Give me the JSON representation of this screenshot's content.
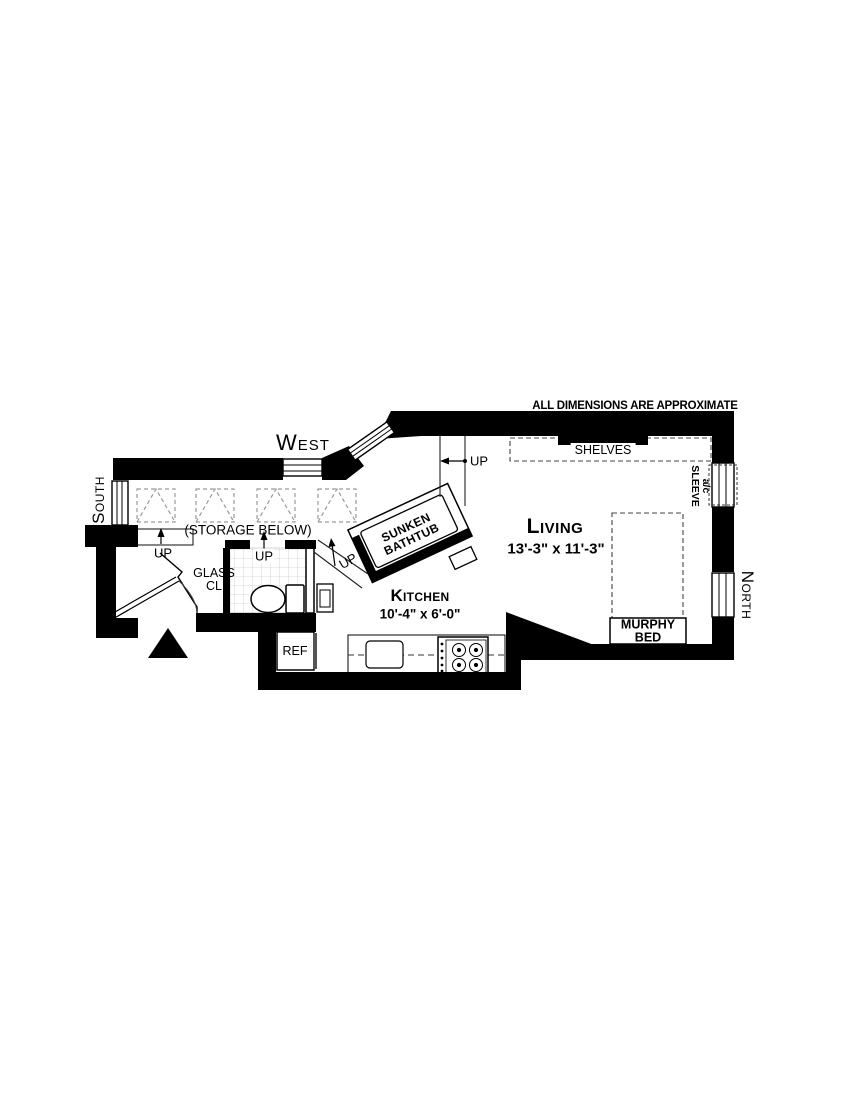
{
  "floorplan": {
    "disclaimer": "ALL DIMENSIONS ARE APPROXIMATE",
    "compass": {
      "west": "West",
      "south": "South",
      "north": "North"
    },
    "rooms": {
      "living": {
        "name": "Living",
        "dims": "13'-3\" x 11'-3\""
      },
      "kitchen": {
        "name": "Kitchen",
        "dims": "10'-4\" x 6'-0\""
      }
    },
    "labels": {
      "shelves": "SHELVES",
      "storage_below": "(STORAGE BELOW)",
      "glass_closet_1": "GLASS",
      "glass_closet_2": "CL",
      "bathtub_1": "SUNKEN",
      "bathtub_2": "BATHTUB",
      "murphy_1": "MURPHY",
      "murphy_2": "BED",
      "refrigerator": "REF",
      "ac_sleeve_1": "a/c",
      "ac_sleeve_2": "SLEEVE",
      "up": "UP"
    },
    "colors": {
      "wall": "#000000",
      "line": "#1a1a1a",
      "dashed_gray": "#9a9a9a",
      "tile": "#cccccc"
    }
  }
}
